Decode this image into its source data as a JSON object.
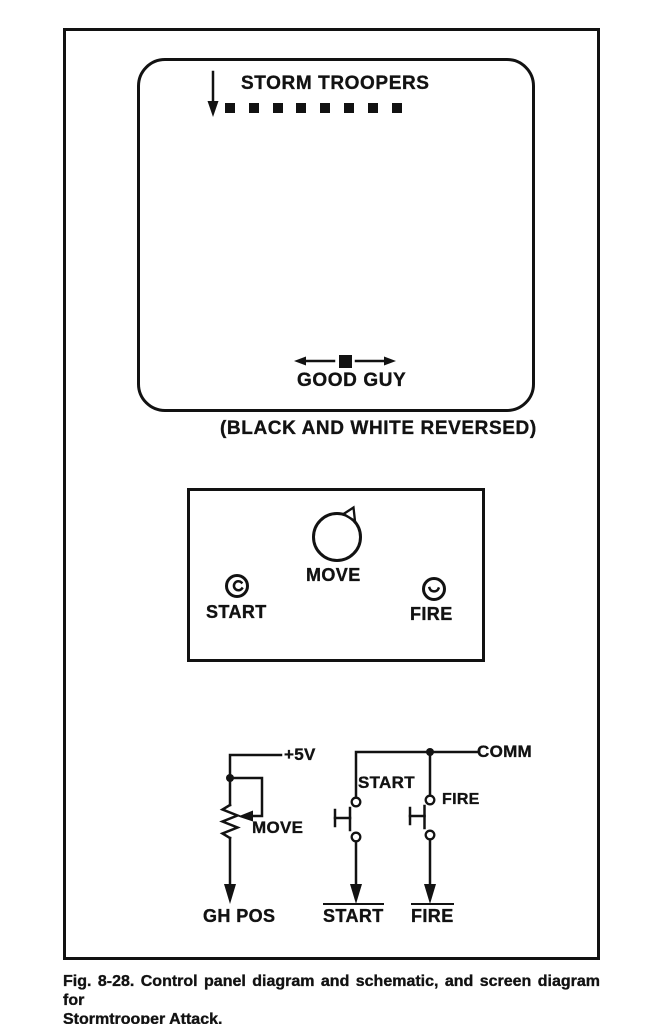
{
  "screen": {
    "troopers_label": "STORM TROOPERS",
    "trooper_count": 8,
    "good_guy_label": "GOOD GUY",
    "note": "(BLACK AND WHITE REVERSED)"
  },
  "control_panel": {
    "move_label": "MOVE",
    "start_label": "START",
    "fire_label": "FIRE"
  },
  "schematic": {
    "supply_label": "+5V",
    "pot_label": "MOVE",
    "pot_output_label": "GH POS",
    "comm_label": "COMM",
    "start_switch_label": "START",
    "fire_switch_label": "FIRE",
    "start_output_label": "START",
    "fire_output_label": "FIRE"
  },
  "caption": {
    "line1": "Fig. 8-28. Control panel diagram and schematic, and screen diagram for",
    "line2": "Stormtrooper Attack."
  },
  "colors": {
    "ink": "#121212",
    "paper": "#ffffff"
  }
}
